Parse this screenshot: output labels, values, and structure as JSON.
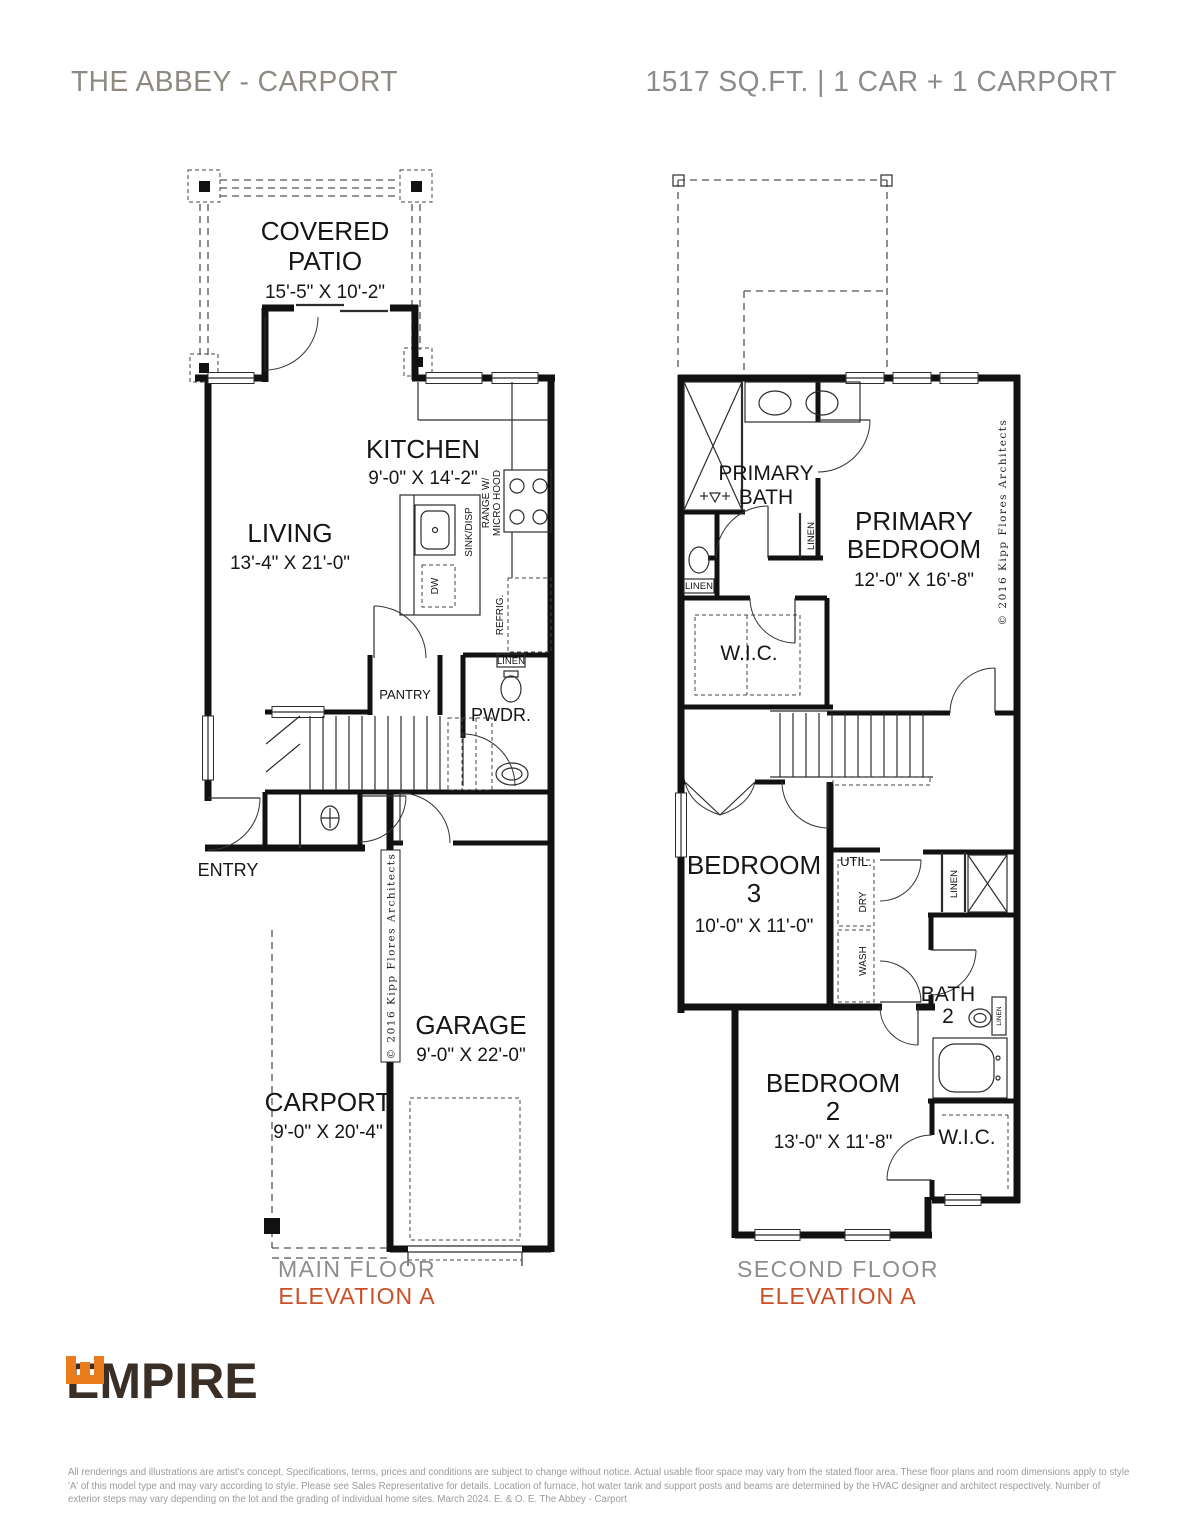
{
  "header": {
    "title": "THE ABBEY - CARPORT",
    "specs": "1517 SQ.FT. | 1 CAR + 1 CARPORT"
  },
  "colors": {
    "title_gray": "#8e8a81",
    "specs_gray": "#8b8b89",
    "floor_caption_gray": "#8d8d8d",
    "elevation_orange": "#cb4e26",
    "logo_orange": "#ea7c1c",
    "logo_brown": "#3a2f26",
    "wall_black": "#111111"
  },
  "labels": {
    "linen": "LINEN",
    "wash": "WASH",
    "dry": "DRY",
    "util": "UTIL.",
    "pantry": "PANTRY",
    "pwdr": "PWDR.",
    "entry": "ENTRY",
    "wic": "W.I.C.",
    "sink_disp": "SINK/DISP",
    "dw": "DW",
    "range_w": "RANGE W/",
    "micro_hood": "MICRO HOOD",
    "refrig": "REFRIG.",
    "copyright": "© 2016 Kipp Flores Architects"
  },
  "main_floor": {
    "caption_floor": "MAIN FLOOR",
    "caption_elevation": "ELEVATION A",
    "rooms": {
      "patio": {
        "n1": "COVERED",
        "n2": "PATIO",
        "dims": "15'-5\" X 10'-2\""
      },
      "living": {
        "n1": "LIVING",
        "dims": "13'-4\" X 21'-0\""
      },
      "kitchen": {
        "n1": "KITCHEN",
        "dims": "9'-0\" X 14'-2\""
      },
      "garage": {
        "n1": "GARAGE",
        "dims": "9'-0\" X 22'-0\""
      },
      "carport": {
        "n1": "CARPORT",
        "dims": "9'-0\" X 20'-4\""
      }
    }
  },
  "second_floor": {
    "caption_floor": "SECOND FLOOR",
    "caption_elevation": "ELEVATION A",
    "rooms": {
      "primary_bath": {
        "n1": "PRIMARY",
        "n2": "BATH"
      },
      "primary_bedroom": {
        "n1": "PRIMARY",
        "n2": "BEDROOM",
        "dims": "12'-0\" X 16'-8\""
      },
      "bedroom3": {
        "n1": "BEDROOM",
        "n2": "3",
        "dims": "10'-0\" X 11'-0\""
      },
      "bedroom2": {
        "n1": "BEDROOM",
        "n2": "2",
        "dims": "13'-0\" X 11'-8\""
      },
      "bath2": {
        "n1": "BATH",
        "n2": "2"
      }
    }
  },
  "footer": {
    "logo_text": "EMPIRE",
    "disclaimer": "All renderings and illustrations are artist's concept. Specifications, terms, prices and conditions are subject to change without notice. Actual usable floor space may vary from the stated floor area. These floor plans and room dimensions apply to style 'A' of this model type and may vary according to style. Please see Sales Representative for details. Location of furnace, hot water tank and support posts and beams are determined by the HVAC designer and architect respectively. Number of exterior steps may vary depending on the lot and the grading of individual home sites. March 2024. E. & O. E. The Abbey - Carport"
  }
}
